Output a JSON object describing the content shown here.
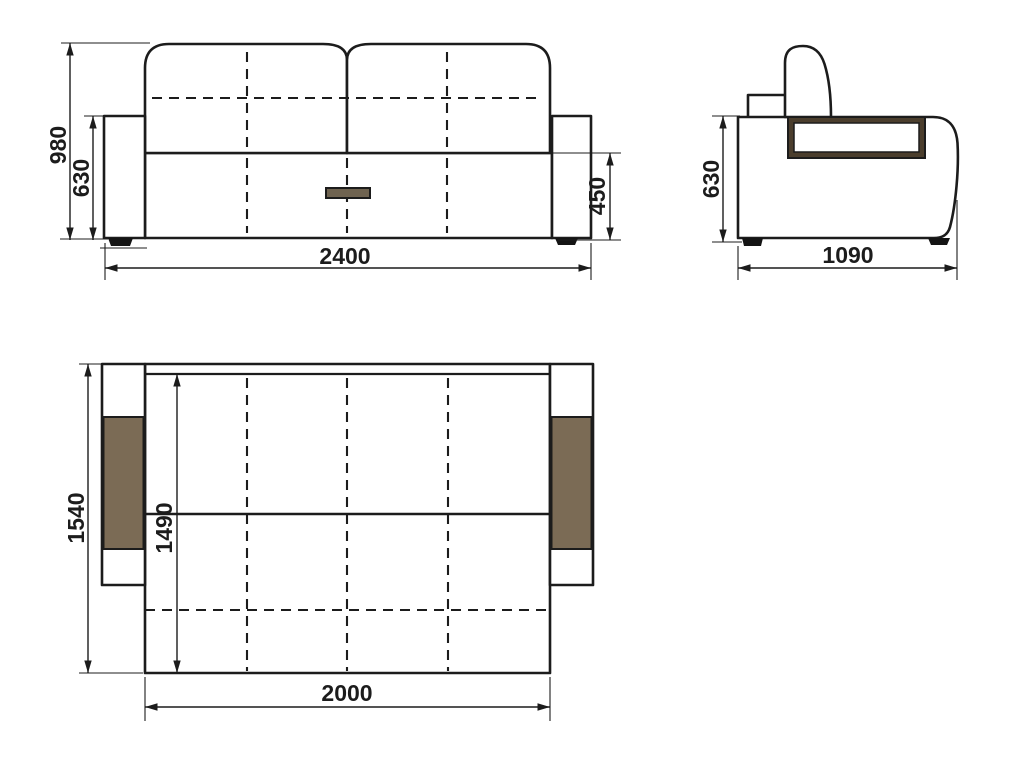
{
  "colors": {
    "line": "#1c1c1c",
    "upholstery_brown": "#7b6b55",
    "panel_border_brown": "#4b3e2d",
    "handle_brown": "#6f6350",
    "foot_black": "#141414",
    "background": "#ffffff"
  },
  "views": {
    "front": {
      "dims": {
        "overall_height": "980",
        "armrest_height": "630",
        "overall_width": "2400",
        "seat_height": "450"
      }
    },
    "side": {
      "dims": {
        "height": "630",
        "depth": "1090"
      }
    },
    "top_unfolded": {
      "dims": {
        "overall_depth": "1540",
        "sleeping_length": "1490",
        "sleeping_width": "2000"
      }
    }
  }
}
